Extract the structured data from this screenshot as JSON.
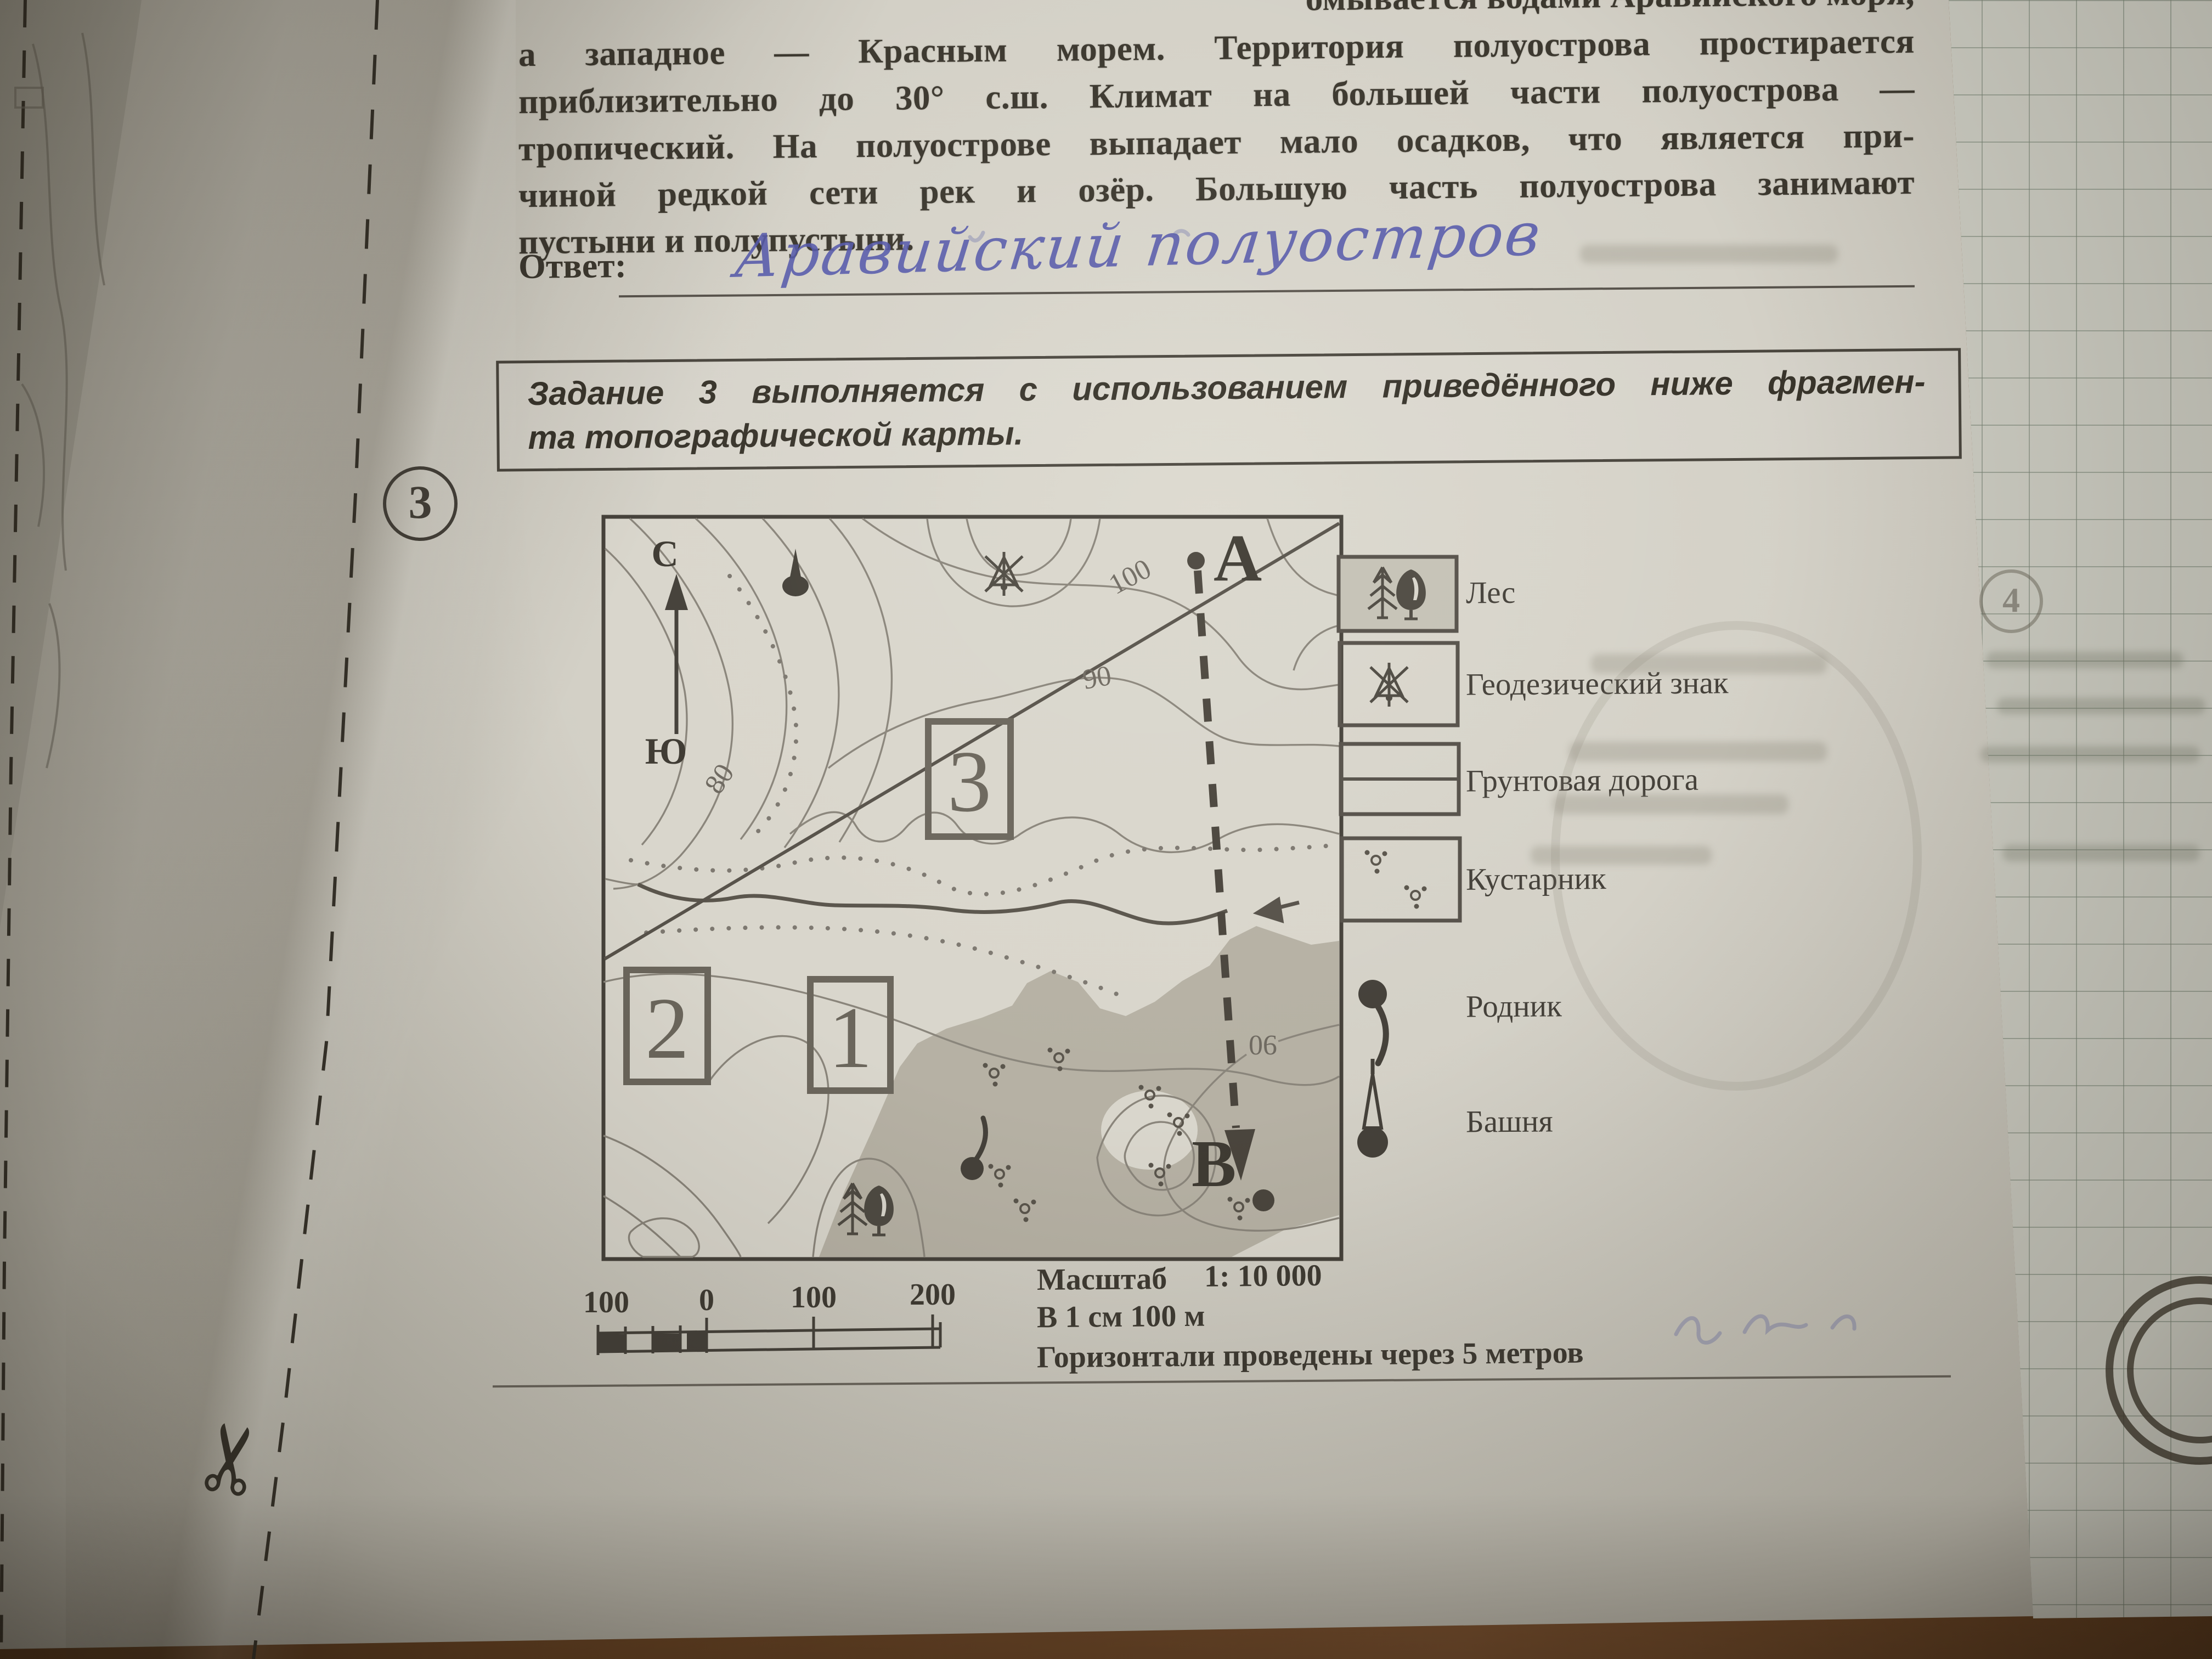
{
  "passage": {
    "clipped_line": "омывается водами Аравийского моря,",
    "lines": [
      "а западное — Красным морем. Территория полуострова простирается",
      "приблизительно до 30° с.ш. Климат на большей части полуострова —",
      "тропический. На полуострове выпадает мало осадков, что является при-",
      "чиной редкой сети рек и озёр. Большую часть полуострова занимают",
      "пустыни и полупустыни."
    ],
    "answer_label": "Ответ:",
    "answer_handwritten": "Аравийский полуостров"
  },
  "task_note": {
    "line1": "Задание 3 выполняется с использованием приведённого ниже фрагмен-",
    "line2": "та топографической карты."
  },
  "task_number": "3",
  "map": {
    "north": "С",
    "south": "Ю",
    "point_a": "А",
    "point_b": "В",
    "labels": {
      "contour_100": "100",
      "contour_90": "90",
      "contour_80": "80",
      "contour_90_rotated": "90",
      "site_1": "1",
      "site_2": "2",
      "site_3": "3"
    }
  },
  "legend": {
    "items": [
      {
        "id": "forest",
        "label": "Лес"
      },
      {
        "id": "geodetic-sign",
        "label": "Геодезический знак"
      },
      {
        "id": "dirt-road",
        "label": "Грунтовая дорога"
      },
      {
        "id": "shrub",
        "label": "Кустарник"
      },
      {
        "id": "spring",
        "label": "Родник"
      },
      {
        "id": "tower",
        "label": "Башня"
      }
    ]
  },
  "scale": {
    "bar_labels": [
      "100",
      "0",
      "100",
      "200"
    ],
    "title": "Масштаб",
    "ratio": "1: 10 000",
    "per_cm": "В 1 см 100 м",
    "note": "Горизонтали проведены через 5 метров"
  },
  "margin_bleed": {
    "circled_number": "4"
  }
}
